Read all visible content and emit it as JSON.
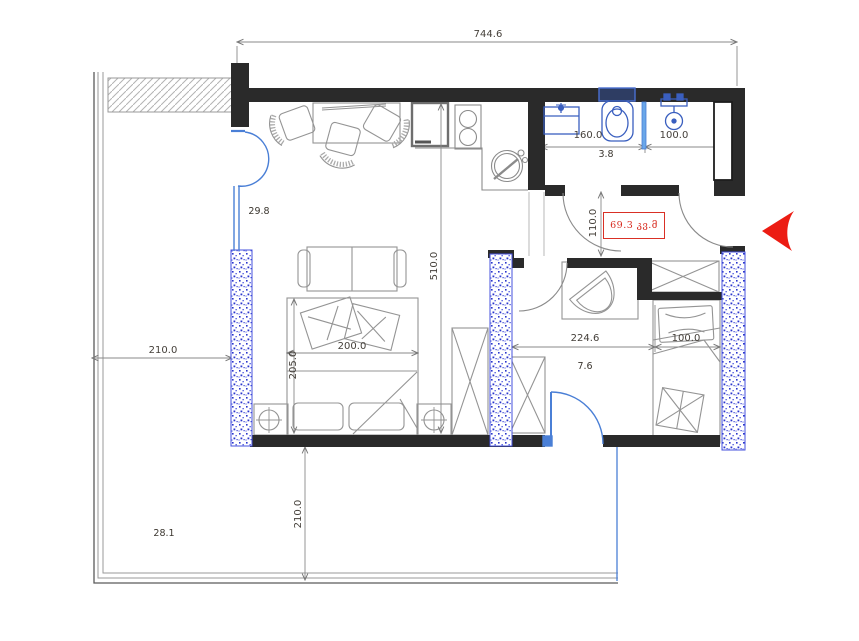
{
  "title": "apartment-floor-plan",
  "dims": {
    "overall_width": "744.6",
    "bath_width": "160.0",
    "shower_width": "100.0",
    "hall_opening_height": "110.0",
    "apartment_depth": "510.0",
    "bed_width": "200.0",
    "bed_length": "205.0",
    "terrace_width": "210.0",
    "kids_room_width": "224.6",
    "kids_bed_width": "100.0",
    "terrace_depth": "210.0"
  },
  "areas": {
    "living_kitchen": "29.8",
    "bathroom": "3.8",
    "kids_room": "7.6",
    "terrace": "28.1",
    "total": "69.3 კვ.მ"
  },
  "colors": {
    "wall": "#2a2a2a",
    "fixture_blue": "#3a5fbf",
    "glazing_blue": "#4a7fd6",
    "column_blue": "#2a35cc",
    "dimension_gray": "#8a8a8a",
    "furniture_gray": "#949494",
    "accent_red": "#e02317",
    "label_text": "#45403a"
  },
  "icons": {
    "entrance_arrow": "entrance-direction-arrow"
  }
}
